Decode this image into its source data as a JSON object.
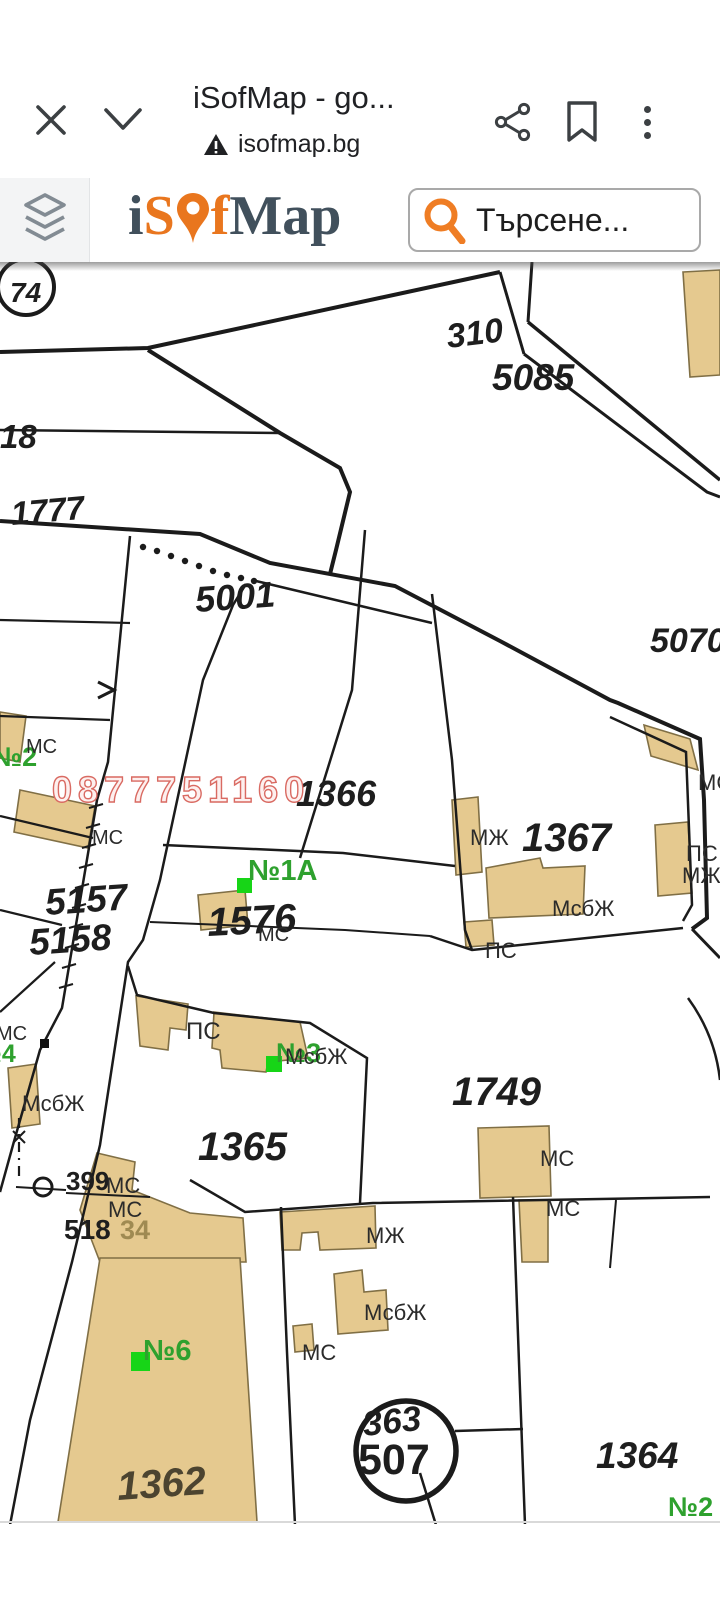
{
  "browser": {
    "title": "iSofMap - go...",
    "url": "isofmap.bg",
    "close_icon": "close-x",
    "collapse_icon": "chevron-down",
    "share_icon": "share",
    "bookmark_icon": "bookmark",
    "menu_icon": "three-dot-menu"
  },
  "appbar": {
    "logo_i": "i",
    "logo_s": "S",
    "logo_f": "f",
    "logo_map": "Map",
    "search_placeholder": "Търсене...",
    "accent_orange": "#e9761e",
    "logo_slate": "#41505c"
  },
  "map": {
    "building_fill": "#e5c98f",
    "label_green": "#2ea12e",
    "watermark_pink": "#d96a62",
    "labels": [
      {
        "text": "74"
      },
      {
        "text": "310"
      },
      {
        "text": "5085"
      },
      {
        "text": "18"
      },
      {
        "text": "1777"
      },
      {
        "text": "5001"
      },
      {
        "text": "5070"
      },
      {
        "text": "№2"
      },
      {
        "text": "МС"
      },
      {
        "text": "1366"
      },
      {
        "text": "МС"
      },
      {
        "text": "МЖ"
      },
      {
        "text": "1367"
      },
      {
        "text": "ПС"
      },
      {
        "text": "МЖ"
      },
      {
        "text": "МС"
      },
      {
        "text": "№1А"
      },
      {
        "text": "5157"
      },
      {
        "text": "5158"
      },
      {
        "text": "1576"
      },
      {
        "text": "МС"
      },
      {
        "text": "МсбЖ"
      },
      {
        "text": "ПС"
      },
      {
        "text": "МС"
      },
      {
        "text": "№4"
      },
      {
        "text": "МсбЖ"
      },
      {
        "text": "ПС"
      },
      {
        "text": "№3"
      },
      {
        "text": "МсбЖ"
      },
      {
        "text": "1749"
      },
      {
        "text": "МС"
      },
      {
        "text": "1365"
      },
      {
        "text": "399"
      },
      {
        "text": "МС"
      },
      {
        "text": "МС"
      },
      {
        "text": "518"
      },
      {
        "text": "34"
      },
      {
        "text": "МЖ"
      },
      {
        "text": "МсбЖ"
      },
      {
        "text": "МС"
      },
      {
        "text": "МС"
      },
      {
        "text": "№6"
      },
      {
        "text": "1362"
      },
      {
        "text": "363"
      },
      {
        "text": "507"
      },
      {
        "text": "1364"
      },
      {
        "text": "№2"
      },
      {
        "text": "0877751160"
      }
    ]
  }
}
